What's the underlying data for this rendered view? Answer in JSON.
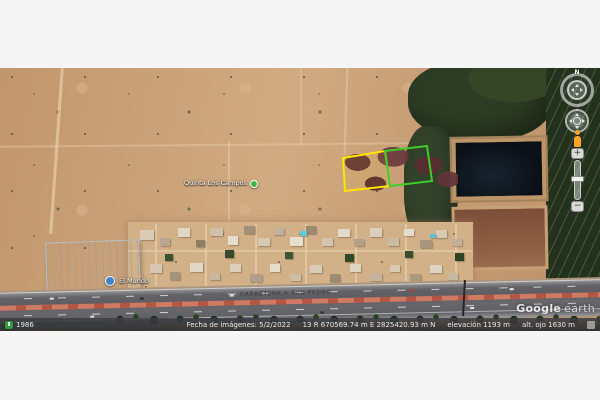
{
  "watermark": {
    "brand": "Google",
    "product": "earth"
  },
  "status_bar": {
    "history_year": "1986",
    "imagery_date": "Fecha de imágenes: 5/2/2022",
    "coordinates": "13 R  670569.74 m E  2825420.93 m N",
    "elevation": "elevación  1193 m",
    "eye_altitude": "alt. ojo  1630 m"
  },
  "map_labels": {
    "quinta_poi": "Quinta Los Campos",
    "business_poi": "El Mundo",
    "road_name": "CARRETERA A SAN PEDRO"
  },
  "nav_controls": {
    "north": "N",
    "zoom_in": "+",
    "zoom_out": "−"
  },
  "parcels": {
    "yellow_points": "343,90 385,83 390,118 345,123",
    "green_points": "385,83 427,78 432,113 390,118",
    "yellow_outline_color": "#ffe400",
    "green_outline_color": "#3ecb2d"
  },
  "colors": {
    "desert": "#c79e76",
    "trees": "#2d3c24",
    "pond": "#0b1016",
    "plowed_field": "#84553d",
    "asphalt": "#606066",
    "median": "#cf7a63",
    "status_bar_bg": "#26282b"
  }
}
